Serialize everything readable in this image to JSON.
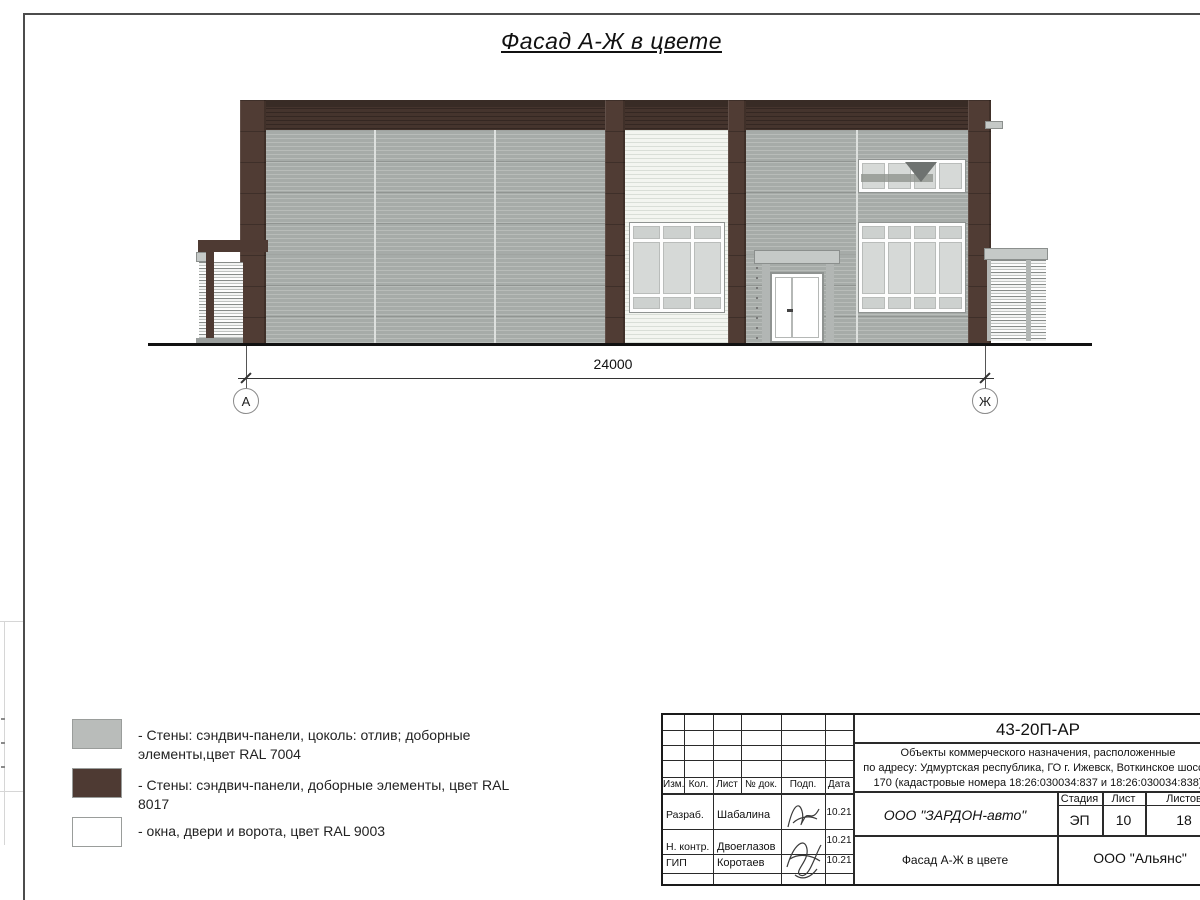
{
  "title": "Фасад А-Ж в цвете",
  "drawing": {
    "dimension_label": "24000",
    "axis_left": "А",
    "axis_right": "Ж"
  },
  "legend": {
    "items": [
      {
        "label": "- Стены: сэндвич-панели, цоколь: отлив; доборные\nэлементы,цвет RAL 7004"
      },
      {
        "label": "- Стены: сэндвич-панели, доборные элементы, цвет RAL 8017"
      },
      {
        "label": "- окна, двери и ворота, цвет RAL 9003"
      }
    ]
  },
  "title_block": {
    "doc_number": "43-20П-АР",
    "description_line1": "Объекты коммерческого назначения, расположенные",
    "description_line2": "по адресу: Удмуртская республика, ГО г. Ижевск, Воткинское шоссе,",
    "description_line3": "170 (кадастровые номера 18:26:030034:837 и 18:26:030034:838)",
    "columns": [
      "Изм.",
      "Кол.",
      "Лист",
      "№ док.",
      "Подп.",
      "Дата"
    ],
    "rows": [
      {
        "role": "Разраб.",
        "name": "Шабалина",
        "date": "10.21"
      },
      {
        "role": "Н. контр.",
        "name": "Двоеглазов",
        "date": "10.21"
      },
      {
        "role": "ГИП",
        "name": "Коротаев",
        "date": "10.21"
      }
    ],
    "stage_header": "Стадия",
    "sheet_header": "Лист",
    "sheets_header": "Листов",
    "stage": "ЭП",
    "sheet": "10",
    "sheets": "18",
    "client": "ООО \"ЗАРДОН-авто\"",
    "drawing_name": "Фасад А-Ж в цвете",
    "company": "ООО \"Альянс\""
  },
  "colors": {
    "wall_gray_ral7004": "#a6aba8",
    "trim_brown_ral8017": "#4e3a33",
    "white_ral9003": "#ffffff",
    "legend_gray_swatch": "#b9bcba",
    "glass": "#d6d9d7",
    "ground_line": "#111111"
  }
}
